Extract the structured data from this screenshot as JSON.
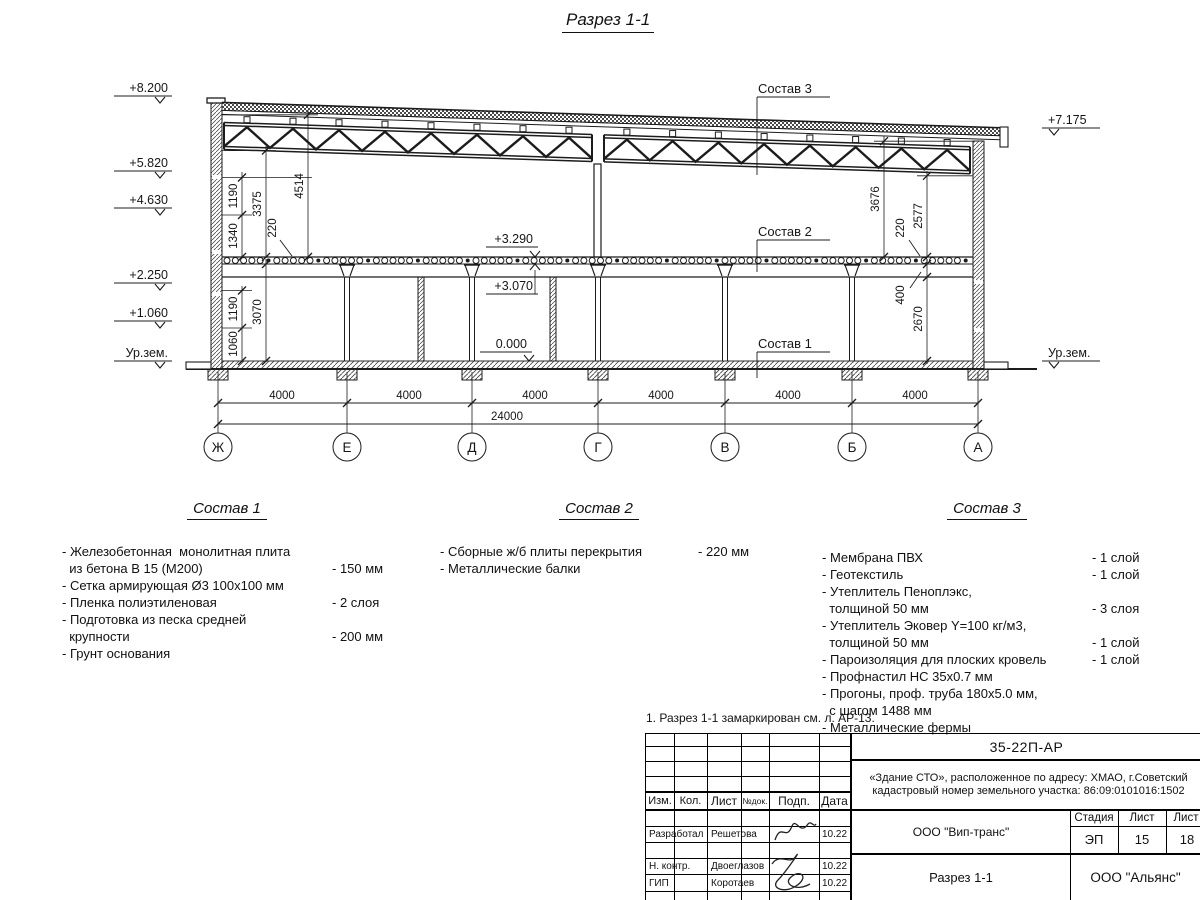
{
  "sheet": {
    "title": "Разрез 1-1"
  },
  "drawing": {
    "elev_left": [
      "+8.200",
      "+5.820",
      "+4.630",
      "+2.250",
      "+1.060",
      "Ур.зем."
    ],
    "elev_right": [
      "+7.175",
      "Ур.зем."
    ],
    "elev_inner": [
      "+3.290",
      "+3.070",
      "0.000"
    ],
    "dims_left": [
      "1190",
      "3375",
      "4514",
      "1340",
      "220",
      "1190",
      "1060",
      "3070"
    ],
    "dims_right": [
      "3676",
      "220",
      "2577",
      "400",
      "2670"
    ],
    "dims_bottom": [
      "4000",
      "4000",
      "4000",
      "4000",
      "4000",
      "4000"
    ],
    "dim_total": "24000",
    "axes": [
      "Ж",
      "Е",
      "Д",
      "Г",
      "В",
      "Б",
      "А"
    ],
    "callouts": [
      "Состав 3",
      "Состав 2",
      "Состав 1"
    ]
  },
  "comp1": {
    "title": "Состав 1",
    "items": [
      {
        "text": "- Железобетонная  монолитная плита\n  из бетона В 15 (М200)",
        "value": "- 150 мм"
      },
      {
        "text": "- Сетка армирующая Ø3 100х100 мм",
        "value": ""
      },
      {
        "text": "- Пленка полиэтиленовая",
        "value": "- 2 слоя"
      },
      {
        "text": "- Подготовка из песка средней\n  крупности",
        "value": "- 200 мм"
      },
      {
        "text": "- Грунт основания",
        "value": ""
      }
    ]
  },
  "comp2": {
    "title": "Состав 2",
    "items": [
      {
        "text": "- Сборные ж/б плиты перекрытия",
        "value": "- 220 мм"
      },
      {
        "text": "- Металлические балки",
        "value": ""
      }
    ]
  },
  "comp3": {
    "title": "Состав 3",
    "items": [
      {
        "text": "- Мембрана ПВХ",
        "value": "- 1 слой"
      },
      {
        "text": "- Геотекстиль",
        "value": "- 1 слой"
      },
      {
        "text": "- Утеплитель Пеноплэкс,\n  толщиной 50 мм",
        "value": "- 3 слоя"
      },
      {
        "text": "- Утеплитель Эковер Y=100 кг/м3,\n  толщиной 50 мм",
        "value": "- 1 слой"
      },
      {
        "text": "- Пароизоляция для плоских кровель",
        "value": "- 1 слой"
      },
      {
        "text": "- Профнастил НС 35х0.7 мм",
        "value": ""
      },
      {
        "text": "- Прогоны, проф. труба 180х5.0 мм,\n  с шагом 1488 мм",
        "value": ""
      },
      {
        "text": "- Металлические фермы",
        "value": ""
      }
    ]
  },
  "note": "1. Разрез 1-1 замаркирован см. л. АР-13.",
  "titleblock": {
    "doc_number": "35-22П-АР",
    "project_line1": "«Здание СТО», расположенное по адресу: ХМАО, г.Советский",
    "project_line2": "кадастровый номер земельного участка: 86:09:0101016:1502",
    "headers": {
      "izm": "Изм.",
      "kol": "Кол.",
      "list": "Лист",
      "ndok": "№док.",
      "podp": "Подп.",
      "data": "Дата",
      "stage": "Стадия",
      "sheet": "Лист",
      "sheets": "Лист"
    },
    "rows": [
      {
        "role": "Разработал",
        "name": "Решетова",
        "date": "10.22"
      },
      {
        "role": "Н. контр.",
        "name": "Двоеглазов",
        "date": "10.22"
      },
      {
        "role": "ГИП",
        "name": "Коротаев",
        "date": "10.22"
      }
    ],
    "org_middle": "ООО \"Вип-транс\"",
    "stage_value": "ЭП",
    "sheet_value": "15",
    "sheets_value": "18",
    "doc_title": "Разрез 1-1",
    "org_right": "ООО \"Альянс\""
  }
}
